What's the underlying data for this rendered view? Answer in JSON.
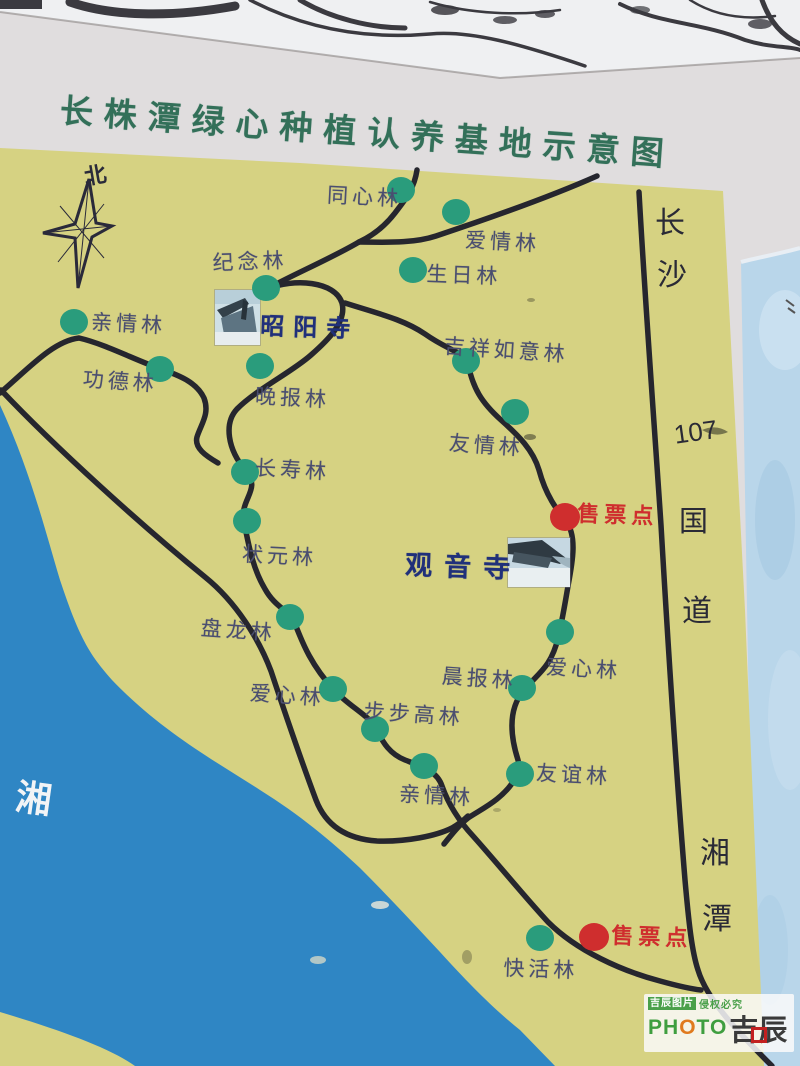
{
  "title": "长株潭绿心种植认养基地示意图",
  "compass_label": "北",
  "map": {
    "forests": [
      {
        "name": "同心林",
        "dot": {
          "x": 401,
          "y": 190
        },
        "label": {
          "x": 328,
          "y": 179,
          "rot": 3
        }
      },
      {
        "name": "爱情林",
        "dot": {
          "x": 456,
          "y": 212
        },
        "label": {
          "x": 466,
          "y": 224,
          "rot": 3
        }
      },
      {
        "name": "生日林",
        "dot": {
          "x": 413,
          "y": 270
        },
        "label": {
          "x": 427,
          "y": 258,
          "rot": 2
        }
      },
      {
        "name": "纪念林",
        "dot": {
          "x": 266,
          "y": 288
        },
        "label": {
          "x": 212,
          "y": 247,
          "rot": -2
        }
      },
      {
        "name": "亲情林",
        "dot": {
          "x": 74,
          "y": 322
        },
        "label": {
          "x": 92,
          "y": 306,
          "rot": 3
        }
      },
      {
        "name": "功德林",
        "dot": {
          "x": 160,
          "y": 369
        },
        "label": {
          "x": 84,
          "y": 363,
          "rot": 4
        }
      },
      {
        "name": "晚报林",
        "dot": {
          "x": 260,
          "y": 366
        },
        "label": {
          "x": 256,
          "y": 380,
          "rot": 3
        }
      },
      {
        "name": "吉祥如意林",
        "dot": {
          "x": 466,
          "y": 361
        },
        "label": {
          "x": 445,
          "y": 330,
          "rot": 4
        }
      },
      {
        "name": "友情林",
        "dot": {
          "x": 515,
          "y": 412
        },
        "label": {
          "x": 450,
          "y": 427,
          "rot": 4
        }
      },
      {
        "name": "长寿林",
        "dot": {
          "x": 245,
          "y": 472
        },
        "label": {
          "x": 256,
          "y": 452,
          "rot": 3
        }
      },
      {
        "name": "状元林",
        "dot": {
          "x": 247,
          "y": 521
        },
        "label": {
          "x": 243,
          "y": 538,
          "rot": 3
        }
      },
      {
        "name": "盘龙林",
        "dot": {
          "x": 290,
          "y": 617
        },
        "label": {
          "x": 202,
          "y": 612,
          "rot": 4
        }
      },
      {
        "name": "爱心林",
        "dot": {
          "x": 333,
          "y": 689
        },
        "label": {
          "x": 251,
          "y": 677,
          "rot": 4
        }
      },
      {
        "name": "步步高林",
        "dot": {
          "x": 375,
          "y": 729
        },
        "label": {
          "x": 365,
          "y": 695,
          "rot": 4
        }
      },
      {
        "name": "晨报林",
        "dot": {
          "x": 522,
          "y": 688
        },
        "label": {
          "x": 443,
          "y": 660,
          "rot": 4
        }
      },
      {
        "name": "爱心林",
        "dot": {
          "x": 560,
          "y": 632
        },
        "label": {
          "x": 547,
          "y": 651,
          "rot": 3
        }
      },
      {
        "name": "友谊林",
        "dot": {
          "x": 520,
          "y": 774
        },
        "label": {
          "x": 537,
          "y": 757,
          "rot": 3
        }
      },
      {
        "name": "亲情林",
        "dot": {
          "x": 424,
          "y": 766
        },
        "label": {
          "x": 400,
          "y": 778,
          "rot": 3
        }
      },
      {
        "name": "快活林",
        "dot": {
          "x": 540,
          "y": 938
        },
        "label": {
          "x": 504,
          "y": 952,
          "rot": 2
        }
      }
    ],
    "ticket_points": [
      {
        "name": "售票点",
        "dot": {
          "x": 565,
          "y": 517
        },
        "label": {
          "x": 578,
          "y": 496,
          "rot": 2
        }
      },
      {
        "name": "售票点",
        "dot": {
          "x": 594,
          "y": 937
        },
        "label": {
          "x": 612,
          "y": 918,
          "rot": 2
        }
      }
    ],
    "temples": [
      {
        "name": "昭阳寺",
        "label": {
          "x": 261,
          "y": 306,
          "rot": 2,
          "size": 24,
          "spacing": 9
        }
      },
      {
        "name": "观音寺",
        "label": {
          "x": 406,
          "y": 543,
          "rot": 2,
          "size": 27,
          "spacing": 12
        }
      }
    ],
    "road_labels": [
      {
        "text": "长",
        "x": 655,
        "y": 198,
        "size": 30,
        "rot": 0
      },
      {
        "text": "沙",
        "x": 657,
        "y": 250,
        "size": 30,
        "rot": 0
      },
      {
        "text": "107",
        "x": 672,
        "y": 420,
        "size": 26,
        "rot": -8
      },
      {
        "text": "国",
        "x": 679,
        "y": 498,
        "size": 29,
        "rot": 0
      },
      {
        "text": "道",
        "x": 682,
        "y": 586,
        "size": 30,
        "rot": 0
      },
      {
        "text": "湘",
        "x": 700,
        "y": 828,
        "size": 30,
        "rot": 0
      },
      {
        "text": "潭",
        "x": 702,
        "y": 894,
        "size": 30,
        "rot": 0
      }
    ],
    "river_label": {
      "text": "湘",
      "x": 20,
      "y": 768,
      "size": 36,
      "rot": 8
    }
  },
  "watermark": {
    "brand_cn": "吉辰图片",
    "notice": "侵权必究",
    "brand_latin": "PHOTO",
    "brand_latin_colors": [
      "#3f9e3f",
      "#3f9e3f",
      "#e07a1e",
      "#3f9e3f",
      "#3f9e3f"
    ],
    "brand_logo": "吉辰"
  },
  "colors": {
    "map_bg": "#d6d282",
    "river": "#2f86c4",
    "road": "#26262e",
    "forest_dot": "#2a9c7c",
    "ticket_red": "#cf2e2e",
    "title_green": "#337059",
    "label_ink": "#4a4e70",
    "temple_ink": "#20307a",
    "sign_white": "#e0ddde",
    "sky": "#eff0f2",
    "side_blue": "#b9d6ea"
  }
}
